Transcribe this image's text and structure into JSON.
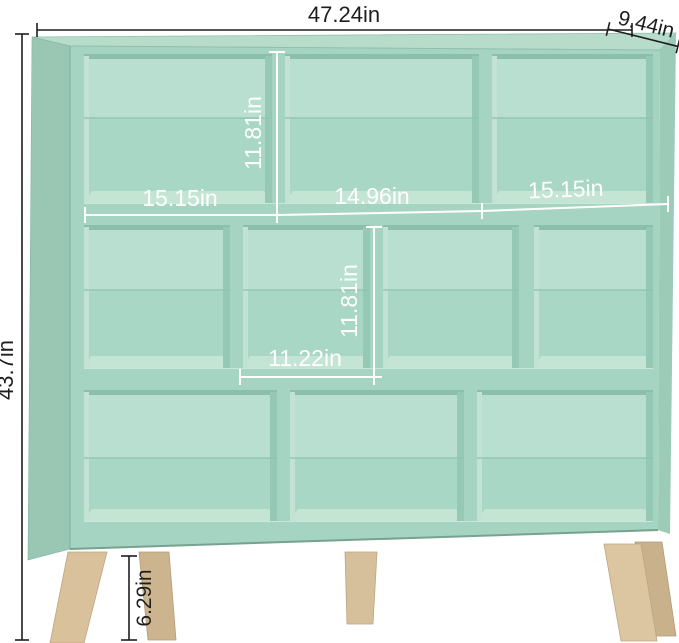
{
  "product_diagram": {
    "description": "Mint green 3-tier 10-cube storage bookshelf with splayed wood legs, annotated with dimensions",
    "overall": {
      "width_label": "47.24in",
      "depth_label": "9.44in",
      "height_label": "43.7in",
      "leg_height_label": "6.29in"
    },
    "interior": {
      "top_cube_height_label": "11.81in",
      "middle_cube_height_label": "11.81in",
      "top_row_width_labels": [
        "15.15in",
        "14.96in",
        "15.15in"
      ],
      "middle_cube_width_label": "11.22in"
    },
    "colors": {
      "shelf_front": "#a6d4c2",
      "shelf_side_panel": "#9ac6b4",
      "shelf_top_face": "#b8dcca",
      "cube_back_upper": "#b9dfd0",
      "cube_back_lower": "#a9d7c5",
      "cube_floor": "#c4e5d4",
      "leg_wood": "#d9c19c",
      "dimension_dark": "#1e1e1e",
      "dimension_light": "#ffffff"
    }
  }
}
